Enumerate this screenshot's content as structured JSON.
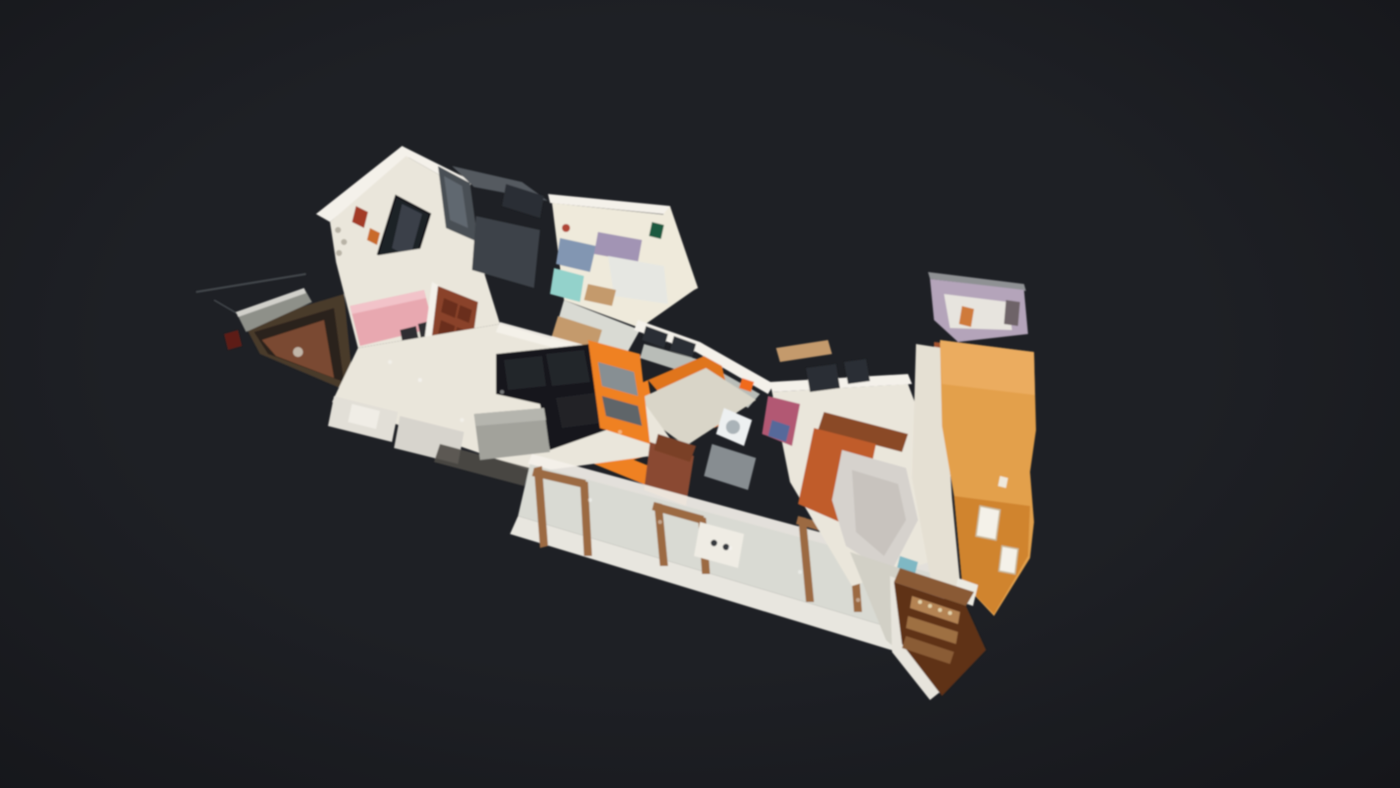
{
  "scene": {
    "kind": "3d-dollhouse-view",
    "description": "Cut-away dollhouse view of a scanned apartment model floating over a dark viewer background",
    "visible_text": [],
    "parts": [
      "left-balcony",
      "antenna-wire",
      "hall-with-mirror",
      "dining-area",
      "wardrobe-slabs",
      "back-bedroom",
      "utility-nook",
      "kitchen",
      "living-room",
      "black-sofa",
      "ottoman",
      "orange-tv-unit",
      "corridor",
      "wood-door-frames",
      "master-bedroom",
      "terracotta-bed",
      "white-duvet",
      "entry-gallery-orange-wall",
      "wood-banister",
      "lavender-bathroom",
      "bar-cabinet",
      "deck-landing"
    ]
  },
  "palette": {
    "bg": "#1e2025",
    "bg_edge": "#15161a",
    "wall": "#f4f1ea",
    "wall_top": "#c6c4bd",
    "wall_cream": "#efeadb",
    "floor": "#eae6db",
    "floor_cool": "#d9dad3",
    "floor_kitchen": "#d9d5c8",
    "slab": "#3e4248",
    "glass": "#2b2f35",
    "mirror": "#1e2226",
    "mirror_sheen": "#3a4149",
    "orange": "#ef8122",
    "orange_deep": "#e0741d",
    "orange_wall": "#e3a04b",
    "orange_wall_shade": "#cd7f2a",
    "orange_wall_light": "#eeb066",
    "wood": "#9c6b43",
    "wood_light": "#c49a6c",
    "wood_dark": "#5f3117",
    "wood_mid": "#8a5a36",
    "maroon": "#7c3722",
    "maroon_light": "#a3532e",
    "sofa": "#17181d",
    "sofa_light": "#23252b",
    "ottoman": "#a2a29b",
    "pink": "#e8a8b0",
    "pink_clutter": "#b25873",
    "teal": "#93d2cb",
    "teal_soft": "#7fb8c4",
    "lavender": "#b4a4ba",
    "terracotta": "#c05b2c",
    "duvet": "#d6d2cd",
    "duvet_shade": "#c4bfba",
    "door": "#8a432a",
    "door_panel": "#6b2f1d",
    "rail": "#8e9089",
    "counter": "#b9bdb8",
    "appliance": "#edf0f1",
    "fascia": "#e8e6df",
    "balcony_body": "#4a3a2c",
    "balcony_inner": "#2c231b",
    "balcony_floor": "#7a4930",
    "roof_gray": "#8f9194",
    "shelf_1": "#b48353",
    "shelf_2": "#9e6f42",
    "shelf_3": "#8a5c35",
    "clutter_blue": "#8296b2",
    "clutter_lav": "#a294b4",
    "bed_sheet": "#e6e7e2",
    "pic_green": "#1e5a40",
    "sparkle": "#ffffff",
    "line": "#45484e"
  }
}
